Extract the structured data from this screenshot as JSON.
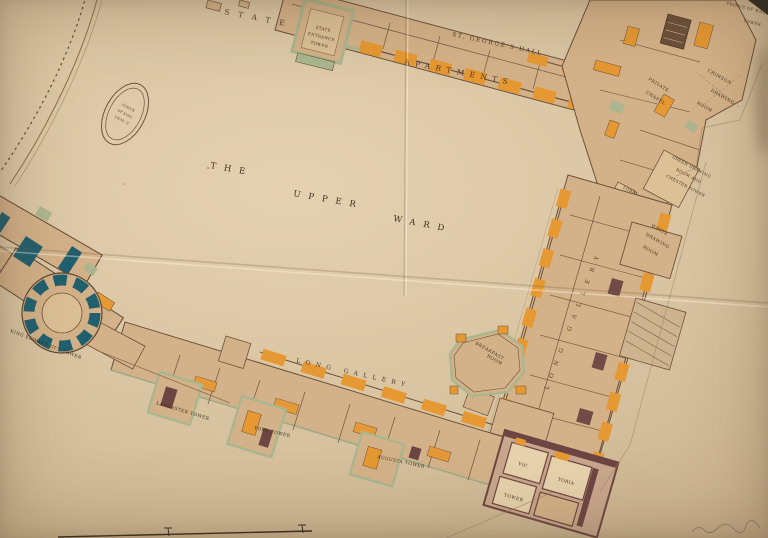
{
  "palette": {
    "paper": "#d9c4a1",
    "room_tan": "#d4b289",
    "room_light": "#dcc096",
    "orange": "#e69832",
    "sage_green": "#a9b68f",
    "wall_brown": "#5f4632",
    "maroon": "#6d4643",
    "teal": "#20606f",
    "cream": "#e6d2ac",
    "ink": "#44331f"
  },
  "labels": {
    "the": "THE",
    "upper": "UPPER",
    "ward": "WARD",
    "state": "STATE",
    "and": "AND",
    "apartments": "APARTMENTS",
    "st_georges_hall": "ST. GEORGE'S HALL",
    "entrance_l1": "STATE",
    "entrance_l2": "ENTRANCE",
    "entrance_l3": "TOWER",
    "prince_l1": "PRINCE OF WALES",
    "prince_l2": "TOWER",
    "chapel_l1": "PRIVATE",
    "chapel_l2": "CHAPEL",
    "crimson_l1": "CRIMSON",
    "crimson_l2": "DRAWING",
    "crimson_l3": "ROOM",
    "green_l1": "GREEN DRAWING",
    "green_l2": "ROOM AND",
    "green_l3": "CHESTER TOWER",
    "lobby": "LOBBY",
    "white_l1": "WHITE",
    "white_l2": "DRAWING",
    "white_l3": "ROOM",
    "long_gallery_east": "LONG GALLERY",
    "long_gallery_south": "LONG GALLERY",
    "breakfast_l1": "BREAKFAST",
    "breakfast_l2": "ROOM",
    "lancaster": "LANCASTER TOWER",
    "york": "YORK TOWER",
    "augusta": "AUGUSTA TOWER",
    "king_edward": "KING EDWARD III'S TOWER",
    "victoria_l1": "VIC",
    "victoria_l2": "TORIA",
    "victoria_l3": "TOWER",
    "statue_l1": "STATUE",
    "statue_l2": "OF KING",
    "statue_l3": "CHAS. II"
  }
}
